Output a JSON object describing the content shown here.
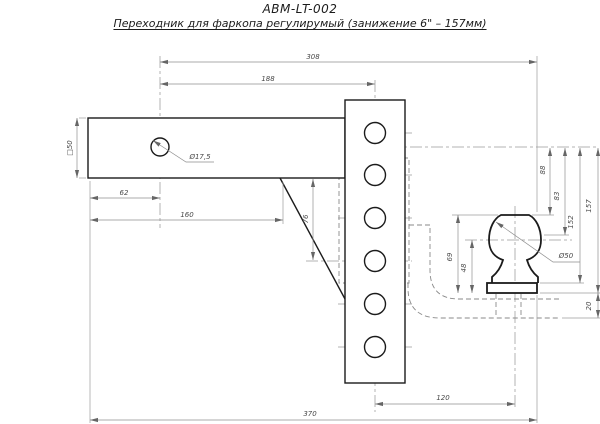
{
  "header": {
    "model_code": "ABM-LT-002",
    "title": "Переходник для фаркопа регулирумый (занижение 6\" – 157мм)"
  },
  "dims": {
    "len_308": "308",
    "len_188": "188",
    "sq_50": "□50",
    "hole_dia": "Ø17,5",
    "len_62": "62",
    "len_160": "160",
    "gusset_76": "76",
    "h_88": "88",
    "h_83": "83",
    "h_152": "152",
    "h_157": "157",
    "h_20": "20",
    "ball_69": "69",
    "ball_48": "48",
    "ball_dia": "Ø50",
    "len_120": "120",
    "len_370": "370"
  },
  "colors": {
    "object_line": "#1b1b1b",
    "dimension_line": "#8f8f8f",
    "background": "#ffffff"
  }
}
